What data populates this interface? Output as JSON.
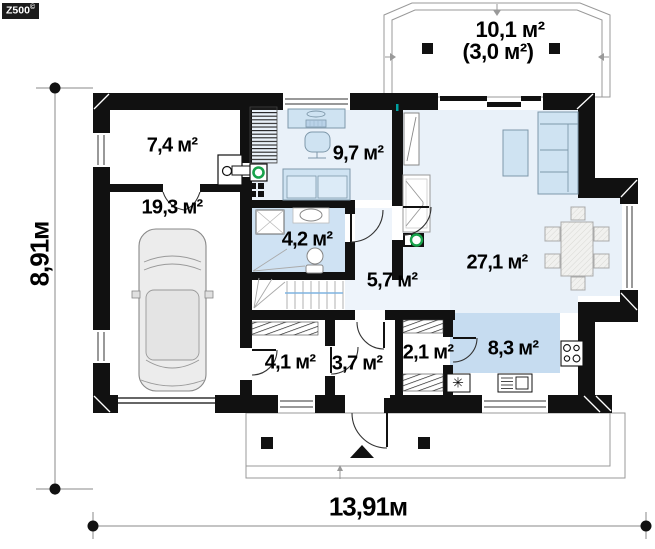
{
  "logo": {
    "text": "Z500",
    "mark": "©"
  },
  "plan": {
    "terrace": {
      "area": "10,1 м²",
      "area_alt": "(3,0 м²)"
    },
    "rooms": {
      "utility": {
        "area": "7,4 м²"
      },
      "garage": {
        "area": "19,3 м²"
      },
      "office": {
        "area": "9,7 м²"
      },
      "bathroom": {
        "area": "4,2 м²"
      },
      "hallway": {
        "area": "5,7 м²"
      },
      "living_room": {
        "area": "27,1 м²"
      },
      "wardrobe": {
        "area": "4,1 м²"
      },
      "entry": {
        "area": "3,7 м²"
      },
      "pantry": {
        "area": "2,1 м²"
      },
      "kitchen": {
        "area": "8,3 м²"
      }
    },
    "dimensions": {
      "width": "13,91м",
      "height": "8,91м"
    },
    "symbols": {
      "fridge": "✳"
    }
  },
  "colors": {
    "wall": "#111111",
    "floor": "#e9f1f9",
    "hallfloor": "#eef4fb",
    "bathfloor": "#cfe2f3",
    "kitchenfloor": "#c6dcf0",
    "fur": "#cfe3f2",
    "furstroke": "#7e98aa",
    "green": "#18a24b",
    "handrail": "#7fb3e0",
    "dimline": "#888888"
  }
}
